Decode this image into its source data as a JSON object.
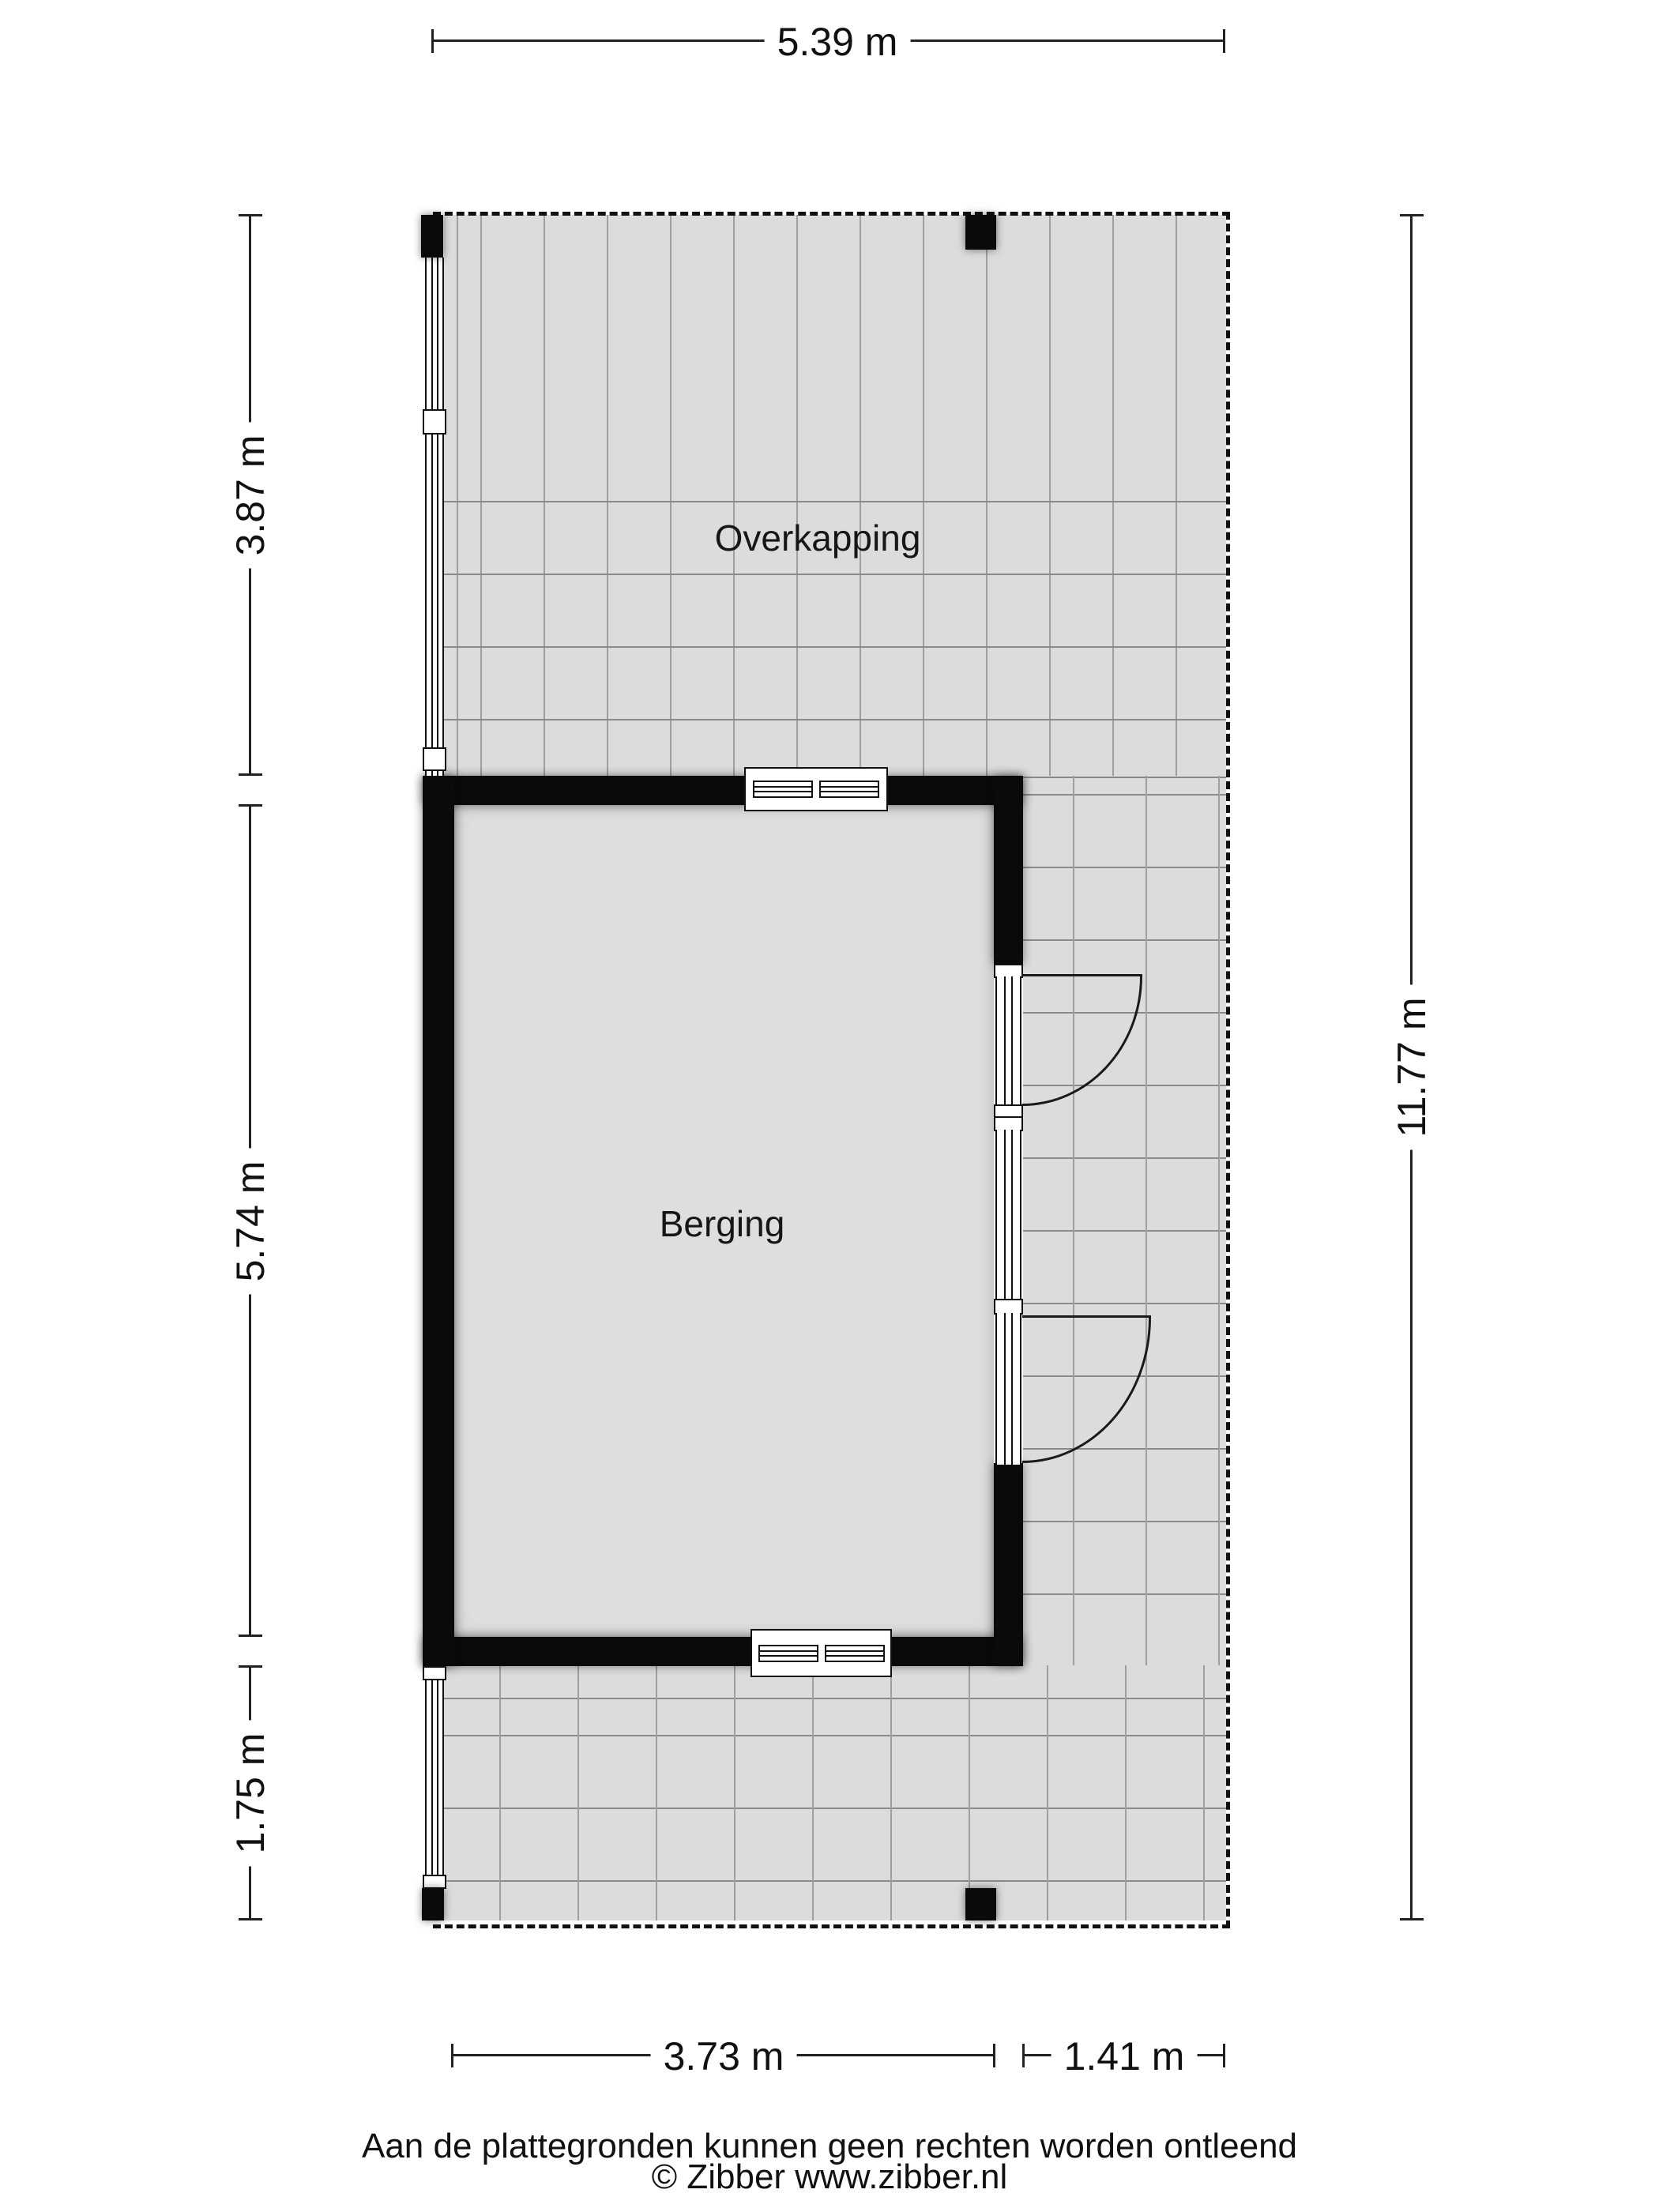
{
  "rooms": {
    "overkapping": "Overkapping",
    "berging": "Berging"
  },
  "dimensions": {
    "top": "5.39 m",
    "left_top": "3.87 m",
    "left_middle": "5.74 m",
    "left_bottom": "1.75 m",
    "right": "11.77 m",
    "bottom_left": "3.73 m",
    "bottom_right": "1.41 m"
  },
  "footer": {
    "disclaimer": "Aan de plattegronden kunnen geen rechten worden ontleend",
    "copyright": "© Zibber www.zibber.nl"
  },
  "colors": {
    "wall": "#0a0a0a",
    "tile_fill": "#dcdcdc",
    "tile_line_vertical": "#9f9f9f",
    "tile_line_horizontal": "#8a8a8a",
    "dashed_boundary": "#111111",
    "page_background": "#ffffff"
  }
}
